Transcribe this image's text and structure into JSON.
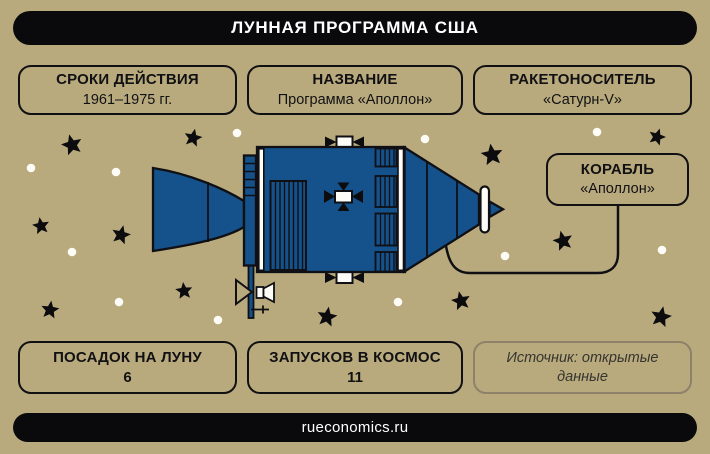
{
  "header": {
    "title": "ЛУННАЯ ПРОГРАММА США"
  },
  "info_boxes": {
    "duration": {
      "label": "СРОКИ ДЕЙСТВИЯ",
      "value": "1961–1975 гг."
    },
    "name": {
      "label": "НАЗВАНИЕ",
      "value": "Программа «Аполлон»"
    },
    "rocket": {
      "label": "РАКЕТОНОСИТЕЛЬ",
      "value": "«Сатурн-V»"
    },
    "ship": {
      "label": "КОРАБЛЬ",
      "value": "«Аполлон»"
    },
    "landings": {
      "label": "ПОСАДОК НА ЛУНУ",
      "value": "6"
    },
    "launches": {
      "label": "ЗАПУСКОВ В КОСМОС",
      "value": "11"
    }
  },
  "source": {
    "text": "Источник: открытые данные"
  },
  "footer": {
    "site": "rueconomics.ru"
  },
  "illustration": {
    "subject": "apollo-spacecraft-side-view"
  },
  "colors": {
    "background": "#b9aa7e",
    "bar_black": "#0a0a0c",
    "ink": "#111113",
    "spacecraft_blue": "#15518a",
    "outline": "#101014",
    "white": "#fdfcf7",
    "source_border": "#8d8269",
    "source_text": "#35342f"
  }
}
